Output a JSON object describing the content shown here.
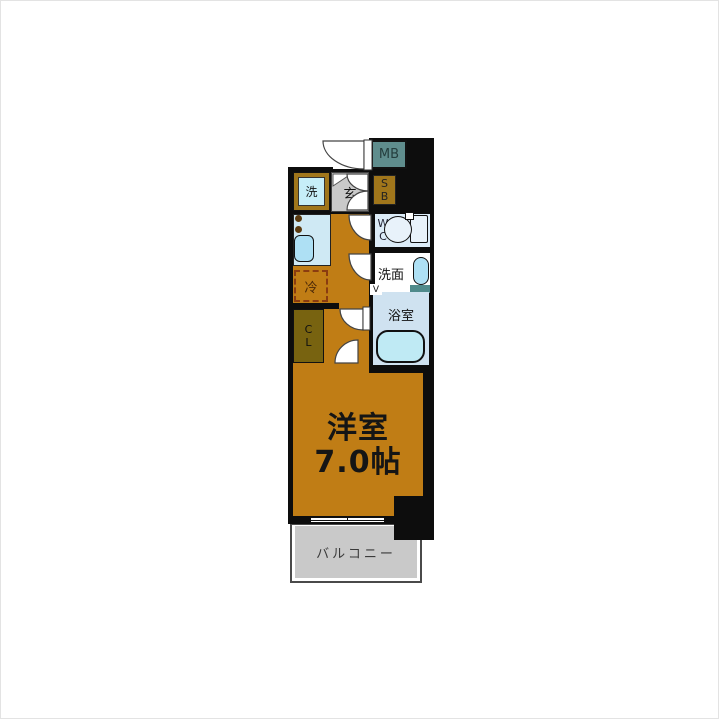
{
  "floorplan": {
    "labels": {
      "meter_box": "MB",
      "shoe_box_lines": [
        "S",
        "B"
      ],
      "entrance": "玄",
      "laundry": "洗",
      "refrigerator": "冷",
      "toilet_lines": [
        "W",
        "C"
      ],
      "washroom": "洗面",
      "bathroom": "浴室",
      "bathroom_door_mark": "V",
      "closet_lines": [
        "C",
        "L"
      ],
      "main_room_name": "洋室",
      "main_room_size": "7.0帖",
      "balcony": "バルコニー"
    },
    "colors": {
      "floor_orange": "#c07d15",
      "wall_black": "#0d0d0d",
      "kitchen_counter": "#cfe9f4",
      "fixture_blue": "#aee0f4",
      "bath_floor": "#cfe2f0",
      "wc_floor": "#dcecf8",
      "tub_fill": "#bfeaf4",
      "meter_box_teal": "#5f8d8d",
      "shoe_box_olive": "#a0761b",
      "closet_olive": "#786310",
      "gray_area": "#c9c9c9",
      "fridge_dash": "#8a3c10"
    }
  }
}
